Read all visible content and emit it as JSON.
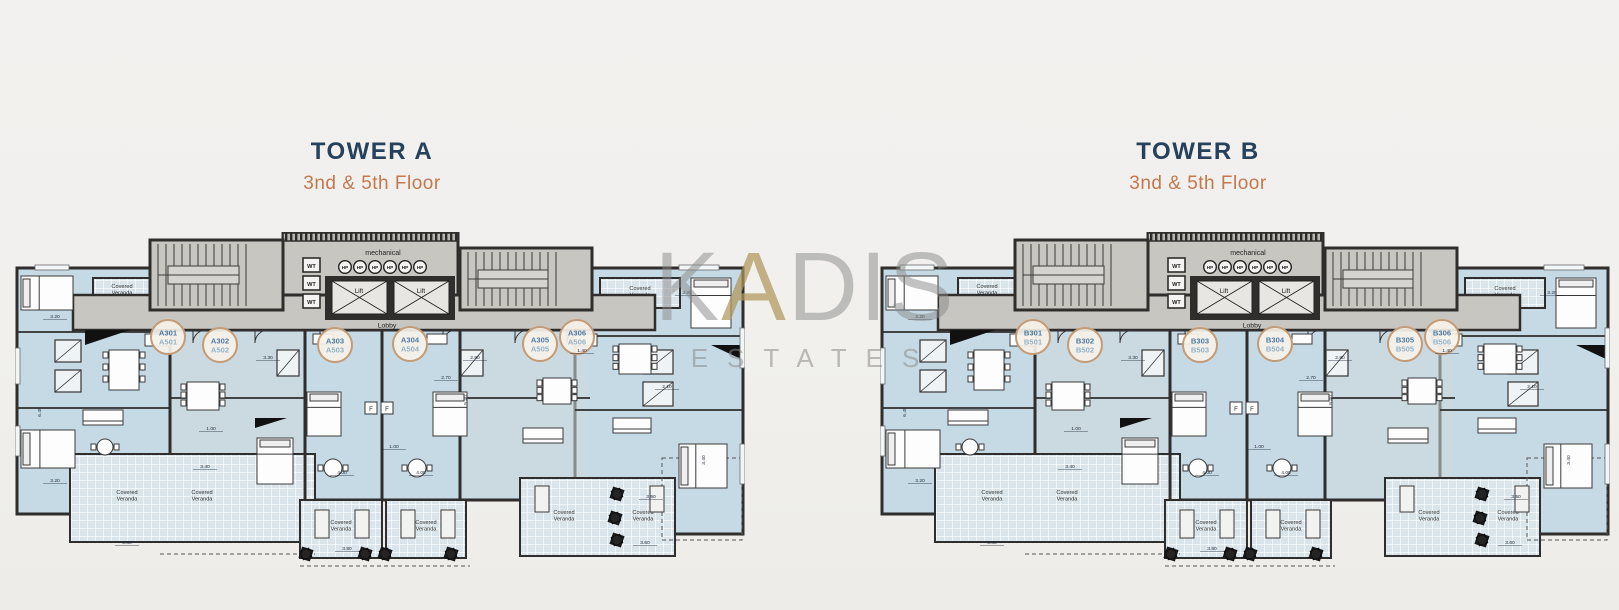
{
  "page": {
    "background": "#f1f0ed"
  },
  "watermark": {
    "line1": "KADIS",
    "line2": "ESTATES"
  },
  "towers": [
    {
      "title": "TOWER A",
      "subtitle": "3nd & 5th Floor",
      "units": [
        [
          "A301",
          "A501"
        ],
        [
          "A302",
          "A502"
        ],
        [
          "A303",
          "A503"
        ],
        [
          "A304",
          "A504"
        ],
        [
          "A305",
          "A505"
        ],
        [
          "A306",
          "A506"
        ]
      ]
    },
    {
      "title": "TOWER B",
      "subtitle": "3nd & 5th Floor",
      "units": [
        [
          "B301",
          "B501"
        ],
        [
          "B302",
          "B502"
        ],
        [
          "B303",
          "B503"
        ],
        [
          "B304",
          "B504"
        ],
        [
          "B305",
          "B505"
        ],
        [
          "B306",
          "B506"
        ]
      ]
    }
  ],
  "plan_labels": {
    "mechanical": "mechanical",
    "lobby": "Lobby",
    "lift": "Lift",
    "water_tank": "WT",
    "heat_pump": "HP",
    "covered_veranda_line1": "Covered",
    "covered_veranda_line2": "Veranda",
    "fridge": "F"
  },
  "dimensions": [
    "3.20",
    "3.20",
    "3.30",
    "2.80",
    "1.40",
    "2.70",
    "3.40",
    "4.00",
    "4.00",
    "1.00",
    "3.50",
    "3.80",
    "3.60",
    "3.80",
    "2.10",
    "6.45",
    "5.40",
    "3.40",
    "3.20",
    "1.00"
  ],
  "colors": {
    "title": "#26415c",
    "subtitle": "#c1794e",
    "wall": "#2f2e2c",
    "room": "#c6dae5",
    "room_alt": "#cfdade",
    "core": "#c8c6c1",
    "veranda": "#d9e5eb",
    "veranda_grid": "#ffffff",
    "badge_ring": "#c39b76",
    "badge_fill": "#f6f2e9",
    "badge_top": "#4e7ba3",
    "badge_bottom": "#93b2c8",
    "dim": "#1f2937"
  }
}
